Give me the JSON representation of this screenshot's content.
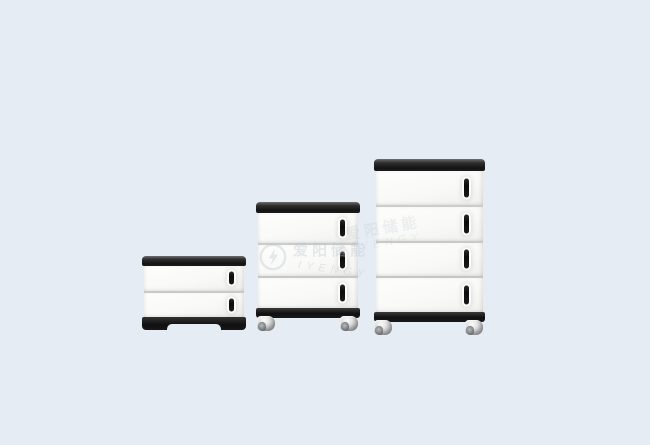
{
  "colors": {
    "background": "#e6ecf3",
    "panel_white": "#f8f8f6",
    "trim_black": "#161616",
    "divider_gray": "#c9c9c7",
    "caster_gray": "#ced1d4",
    "watermark": "#b9c4cf"
  },
  "watermark": {
    "logo": "circle-bolt-monogram",
    "cjk_text": "爱阳储能",
    "latin_text": "IYENGY"
  },
  "units": [
    {
      "name": "small-2-module-cabinet",
      "modules": 2,
      "base": "plinth",
      "casters": false
    },
    {
      "name": "medium-3-module-cabinet",
      "modules": 3,
      "base": "bar",
      "casters": true
    },
    {
      "name": "large-4-module-cabinet",
      "modules": 4,
      "base": "bar",
      "casters": true
    }
  ]
}
